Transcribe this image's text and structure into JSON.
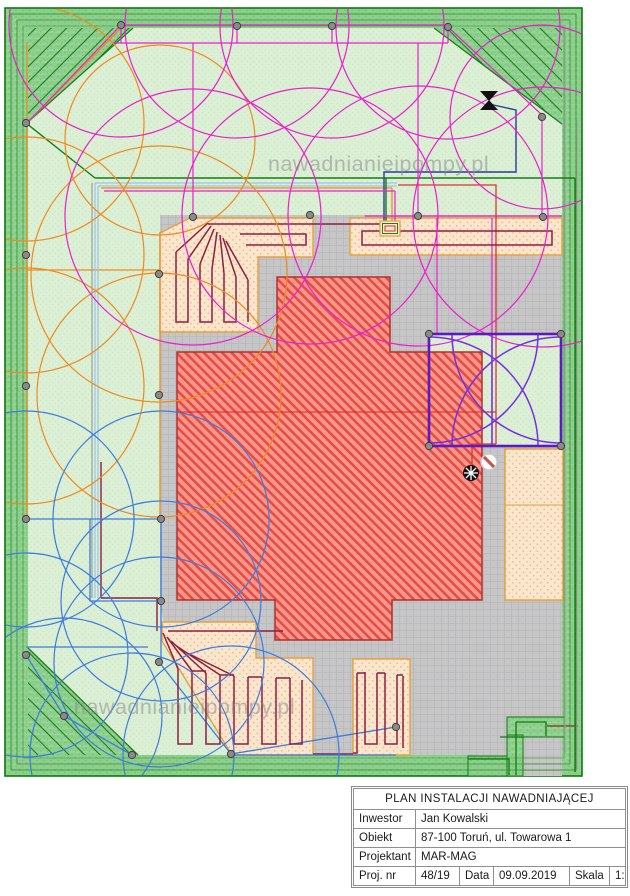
{
  "watermark": {
    "text": "nawadnianieipompy.pl"
  },
  "title_block": {
    "title": "PLAN INSTALACJI NAWADNIAJĄCEJ",
    "rows": [
      {
        "label": "Inwestor",
        "value": "Jan Kowalski"
      },
      {
        "label": "Obiekt",
        "value": "87-100 Toruń, ul. Towarowa 1"
      },
      {
        "label": "Projektant",
        "value": "MAR-MAG"
      }
    ],
    "footer": {
      "proj_label": "Proj. nr",
      "proj_value": "48/19",
      "date_label": "Data",
      "date_value": "09.09.2019",
      "scale_label": "Skala",
      "scale_value": "1:160"
    }
  },
  "plan": {
    "colors": {
      "lawn": "#DBEFD5",
      "hedge_border": "#8CCE8C",
      "frame_green": "#0B7A0B",
      "paving": "#C6C6C7",
      "building_fill": "#F4978F",
      "building_hatch": "#E94B3E",
      "drip_zone_fill": "#FAE6CC",
      "drip_zone_border": "#E5A13F",
      "drip_pipe": "#8C1F42",
      "sprinklers_top": "#EA1FD0",
      "sprinklers_left": "#EF8A1E",
      "sprinklers_bottom": "#3D7BDE",
      "sprinklers_square": "#7430E0",
      "supply_pipe_navy": "#2B3A9E",
      "supply_pipe_red": "#D6382B"
    }
  }
}
